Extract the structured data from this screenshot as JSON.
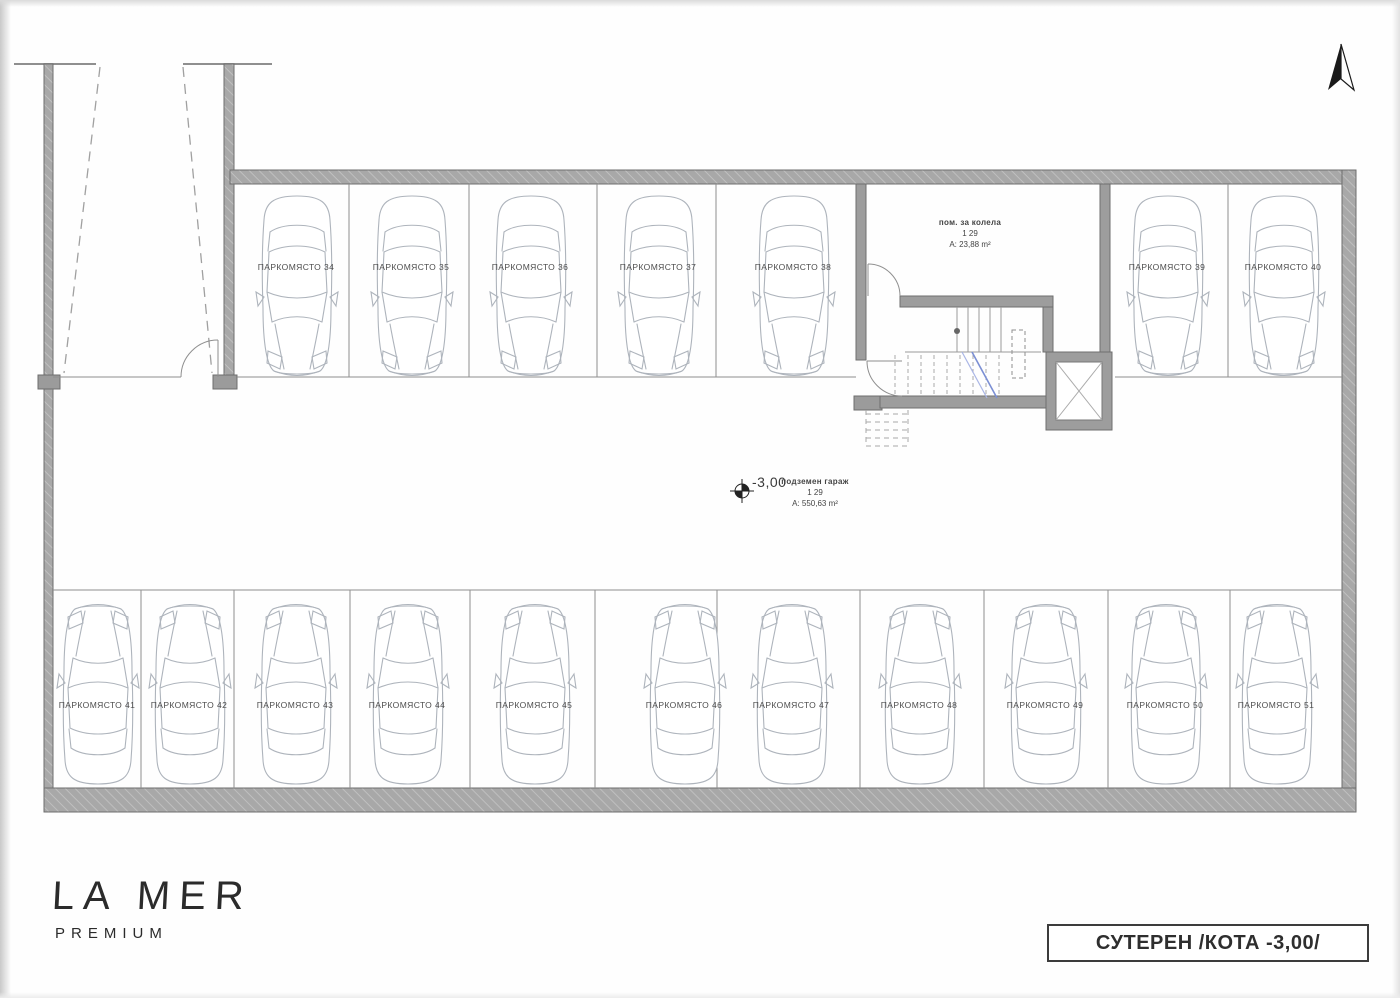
{
  "drawing": {
    "title_block": {
      "label": "СУТЕРЕН /КОТА -3,00/"
    },
    "logo": {
      "title": "LA MER",
      "subtitle": "PREMIUM"
    },
    "level_marker": {
      "value": "-3,00"
    },
    "garage_room": {
      "name": "подземен гараж",
      "number": "1 29",
      "area": "А: 550,63 m²"
    },
    "bike_room": {
      "name": "пом. за колела",
      "number": "1 29",
      "area": "А: 23,88 m²"
    },
    "parking_spaces": [
      {
        "label": "ПАРКОМЯСТО 34"
      },
      {
        "label": "ПАРКОМЯСТО 35"
      },
      {
        "label": "ПАРКОМЯСТО 36"
      },
      {
        "label": "ПАРКОМЯСТО 37"
      },
      {
        "label": "ПАРКОМЯСТО 38"
      },
      {
        "label": "ПАРКОМЯСТО 39"
      },
      {
        "label": "ПАРКОМЯСТО 40"
      },
      {
        "label": "ПАРКОМЯСТО 41"
      },
      {
        "label": "ПАРКОМЯСТО 42"
      },
      {
        "label": "ПАРКОМЯСТО 43"
      },
      {
        "label": "ПАРКОМЯСТО 44"
      },
      {
        "label": "ПАРКОМЯСТО 45"
      },
      {
        "label": "ПАРКОМЯСТО 46"
      },
      {
        "label": "ПАРКОМЯСТО 47"
      },
      {
        "label": "ПАРКОМЯСТО 48"
      },
      {
        "label": "ПАРКОМЯСТО 49"
      },
      {
        "label": "ПАРКОМЯСТО 50"
      },
      {
        "label": "ПАРКОМЯСТО 51"
      }
    ],
    "colors": {
      "wall": "#a8a8a8",
      "wall_edge": "#6e6e6e",
      "thin_line": "#8f8f8f",
      "car_line": "#aeb4bc",
      "stair_arrow_blue": "#7b8fd4",
      "text": "#4d4d4d"
    }
  }
}
